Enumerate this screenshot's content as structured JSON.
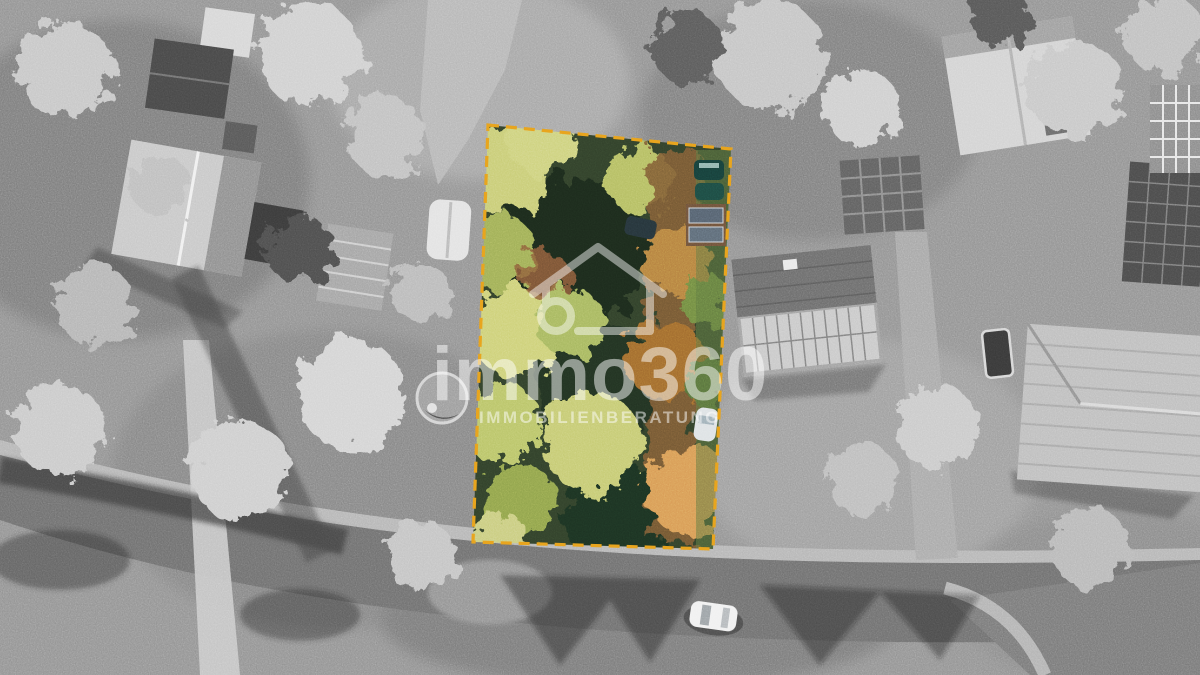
{
  "photo": {
    "kind": "aerial-drone-photograph",
    "style": "grayscale neighborhood with one building plot highlighted in full color",
    "highlight_plot": {
      "outline_color": "#E8A51E",
      "outline_style": "dashed",
      "content": "overgrown garden plot with trees, bushes, two dark parked cars, a small solar-roof outbuilding and a white car on the side strip"
    },
    "surroundings": [
      "detached houses with solar-panel roofs",
      "garden sheds and a greenhouse",
      "round above-ground pool",
      "small rectangular pool",
      "bare winter trees",
      "curving street with a parked white car"
    ]
  },
  "watermark": {
    "icon": "house-360-icon",
    "brand": "immo360",
    "tagline": "IMMOBILIENBERATUNG",
    "color": "#ffffff"
  }
}
